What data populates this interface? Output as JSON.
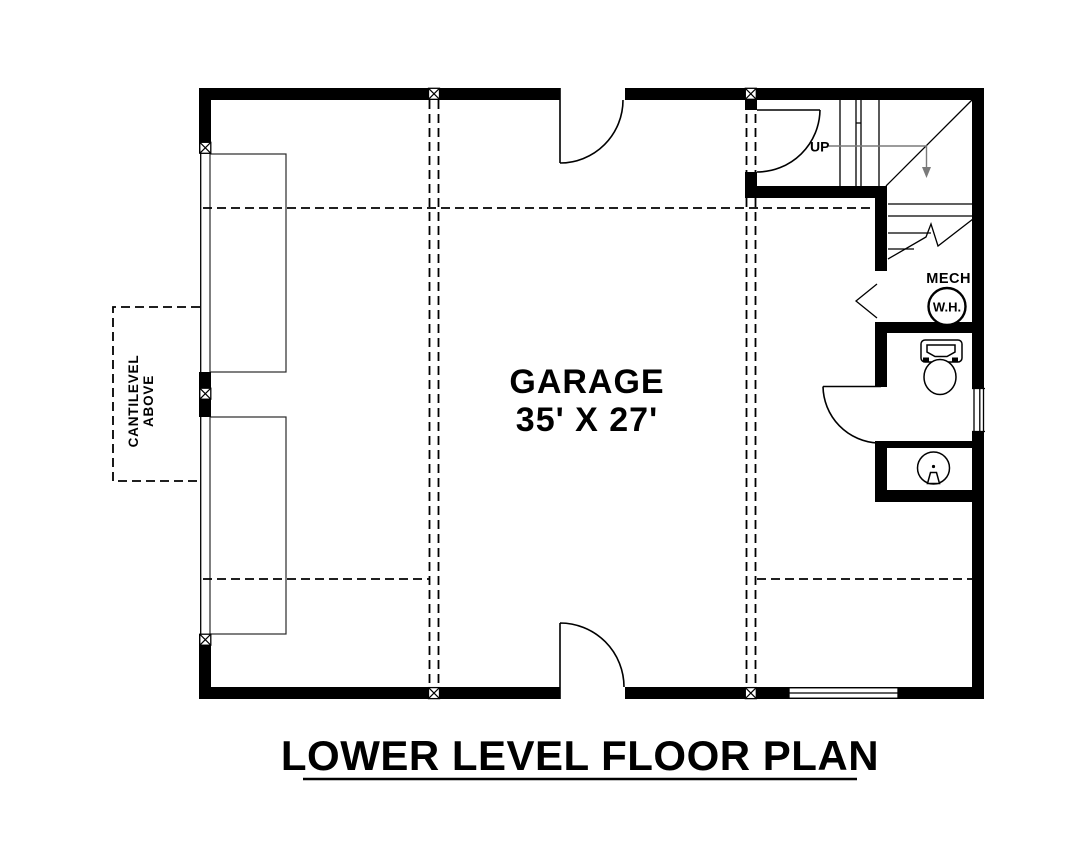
{
  "colors": {
    "paper": "#ffffff",
    "ink": "#000000",
    "arrow": "#7a7a7a"
  },
  "plan": {
    "garage": {
      "label": "GARAGE",
      "dimensions": "35' X 27'"
    },
    "stairs": {
      "direction": "UP"
    },
    "mech_room": {
      "label": "MECH."
    },
    "water_heater": {
      "label": "W.H."
    },
    "cantilever": {
      "line1": "CANTILEVEL",
      "line2": "ABOVE"
    }
  },
  "title": "LOWER LEVEL FLOOR PLAN"
}
